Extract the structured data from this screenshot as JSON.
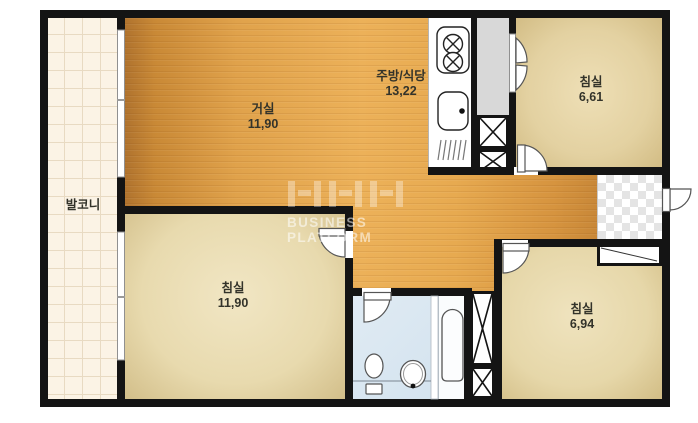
{
  "plan": {
    "rooms": {
      "balcony": {
        "name": "발코니"
      },
      "living": {
        "name": "거실",
        "area": "11,90"
      },
      "kitchen": {
        "name": "주방/식당",
        "area": "13,22"
      },
      "bedroom_top_right": {
        "name": "침실",
        "area": "6,61"
      },
      "bedroom_bottom_left": {
        "name": "침실",
        "area": "11,90"
      },
      "bedroom_bottom_right": {
        "name": "침실",
        "area": "6,94"
      }
    },
    "watermark": {
      "logo": "NHN",
      "subtitle": "BUSINESS PLATFORM"
    },
    "colors": {
      "wall": "#141414",
      "wood_floor": "#e0a24b",
      "bedroom_floor": "#e7d9ae",
      "balcony_tile": "#fbf3e5",
      "bathroom_floor": "#d8e6f1",
      "closet_gray": "#d8d8d8"
    }
  }
}
